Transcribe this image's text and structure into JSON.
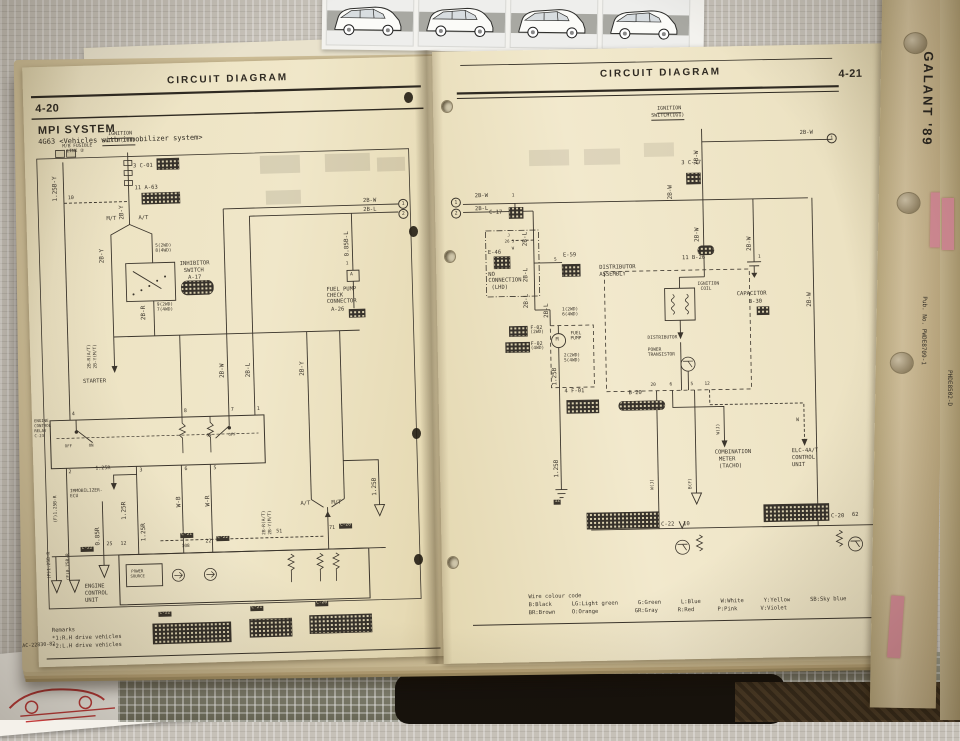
{
  "left_page": {
    "page_number": "4-20",
    "header": "CIRCUIT DIAGRAM",
    "title": "MPI SYSTEM",
    "subtitle": "4G63 <Vehicles with immobilizer system>",
    "footer_code": "AC-22830-82",
    "remarks": {
      "line1": "Remarks",
      "line2": "*1:R.H drive vehicles",
      "line3": "*2:L.H drive vehicles"
    },
    "labels": [
      {
        "t": "M/B FUSIBLE",
        "x": 38,
        "y": 79,
        "s": 4.5
      },
      {
        "t": "LINK ②",
        "x": 42,
        "y": 84,
        "s": 4.5
      },
      {
        "t": "IGNITION",
        "x": 84,
        "y": 67,
        "s": 5,
        "c": "ul"
      },
      {
        "t": "SWITCH(IG1)",
        "x": 78,
        "y": 74,
        "s": 5,
        "c": "ul"
      },
      {
        "t": "1.25B-Y",
        "x": 27,
        "y": 135,
        "c": "rot"
      },
      {
        "t": "10",
        "x": 42,
        "y": 130,
        "s": 5
      },
      {
        "t": "3 C-01",
        "x": 108,
        "y": 100,
        "s": 5.5
      },
      {
        "t": "11 A-63",
        "x": 109,
        "y": 122,
        "s": 5.5
      },
      {
        "t": "2B-Y",
        "x": 93,
        "y": 155,
        "c": "rot"
      },
      {
        "t": "M/T",
        "x": 80,
        "y": 152,
        "s": 5.5
      },
      {
        "t": "A/T",
        "x": 112,
        "y": 152,
        "s": 5.5
      },
      {
        "t": "2B-Y",
        "x": 72,
        "y": 198,
        "c": "rot"
      },
      {
        "t": "5(2WD)",
        "x": 128,
        "y": 181,
        "s": 4.5
      },
      {
        "t": "8(4WD)",
        "x": 128,
        "y": 186,
        "s": 4.5
      },
      {
        "t": "INHIBITOR",
        "x": 152,
        "y": 199,
        "s": 5.5
      },
      {
        "t": "SWITCH",
        "x": 156,
        "y": 206,
        "s": 5.5
      },
      {
        "t": "A-17",
        "x": 160,
        "y": 213,
        "s": 5.5
      },
      {
        "t": "9(2WD)",
        "x": 128,
        "y": 240,
        "s": 4.5
      },
      {
        "t": "7(4WD)",
        "x": 128,
        "y": 245,
        "s": 4.5
      },
      {
        "t": "2B-R",
        "x": 112,
        "y": 256,
        "c": "rot"
      },
      {
        "t": "2B-R(A/T)",
        "x": 58,
        "y": 303,
        "c": "rot",
        "s": 4.5
      },
      {
        "t": "2B-Y(M/T)",
        "x": 64,
        "y": 303,
        "c": "rot",
        "s": 4.5
      },
      {
        "t": "STARTER",
        "x": 52,
        "y": 314,
        "s": 5.5
      },
      {
        "t": "2B-W",
        "x": 189,
        "y": 316,
        "c": "rot"
      },
      {
        "t": "2B-L",
        "x": 215,
        "y": 316,
        "c": "rot"
      },
      {
        "t": "2B-Y",
        "x": 269,
        "y": 316,
        "c": "rot"
      },
      {
        "t": "2B-W",
        "x": 337,
        "y": 141,
        "s": 5.5
      },
      {
        "t": "2B-L",
        "x": 337,
        "y": 150,
        "s": 5.5
      },
      {
        "t": "1",
        "x": 372,
        "y": 142,
        "c": "circ"
      },
      {
        "t": "2",
        "x": 372,
        "y": 152,
        "c": "circ"
      },
      {
        "t": "0.85B-L",
        "x": 317,
        "y": 198,
        "c": "rot"
      },
      {
        "t": "1",
        "x": 318,
        "y": 204,
        "s": 4.5
      },
      {
        "t": "A",
        "x": 322,
        "y": 215,
        "s": 4.5
      },
      {
        "t": "FUEL PUMP",
        "x": 298,
        "y": 229,
        "s": 5.5
      },
      {
        "t": "CHECK",
        "x": 298,
        "y": 235,
        "s": 5.5
      },
      {
        "t": "CONNECTOR",
        "x": 298,
        "y": 241,
        "s": 5.5
      },
      {
        "t": "A-26",
        "x": 302,
        "y": 249,
        "s": 5.5
      },
      {
        "t": "ENGINE",
        "x": 2,
        "y": 352,
        "s": 4
      },
      {
        "t": "CONTROL",
        "x": 2,
        "y": 357,
        "s": 4
      },
      {
        "t": "RELAY",
        "x": 2,
        "y": 362,
        "s": 4
      },
      {
        "t": "C-23",
        "x": 2,
        "y": 367,
        "s": 4
      },
      {
        "t": "4",
        "x": 40,
        "y": 346,
        "s": 5
      },
      {
        "t": "8",
        "x": 152,
        "y": 346,
        "s": 5
      },
      {
        "t": "7",
        "x": 199,
        "y": 346,
        "s": 5
      },
      {
        "t": "1",
        "x": 225,
        "y": 346,
        "s": 5
      },
      {
        "t": "OFF",
        "x": 32,
        "y": 378,
        "s": 4
      },
      {
        "t": "ON",
        "x": 56,
        "y": 378,
        "s": 4
      },
      {
        "t": "ON",
        "x": 174,
        "y": 371,
        "s": 4
      },
      {
        "t": "OFF",
        "x": 196,
        "y": 371,
        "s": 4
      },
      {
        "t": "2",
        "x": 35,
        "y": 404,
        "s": 5
      },
      {
        "t": "3",
        "x": 106,
        "y": 404,
        "s": 5
      },
      {
        "t": "6",
        "x": 151,
        "y": 404,
        "s": 5
      },
      {
        "t": "5",
        "x": 180,
        "y": 404,
        "s": 5
      },
      {
        "t": "1.25R",
        "x": 62,
        "y": 401,
        "s": 5
      },
      {
        "t": "IMMOBILIZER-",
        "x": 36,
        "y": 424,
        "s": 4.5
      },
      {
        "t": "ECU",
        "x": 36,
        "y": 429,
        "s": 4.5
      },
      {
        "t": "(F)1.25B-R",
        "x": 20,
        "y": 456,
        "c": "rot",
        "s": 4.5
      },
      {
        "t": "0.85R",
        "x": 60,
        "y": 480,
        "c": "rot"
      },
      {
        "t": "1.25R",
        "x": 87,
        "y": 455,
        "c": "rot"
      },
      {
        "t": "1.25R",
        "x": 106,
        "y": 477,
        "c": "rot"
      },
      {
        "t": "W-B",
        "x": 142,
        "y": 444,
        "c": "rot"
      },
      {
        "t": "W-R",
        "x": 171,
        "y": 444,
        "c": "rot"
      },
      {
        "t": "C-22",
        "x": 45,
        "y": 481,
        "c": "tag",
        "s": 4.5
      },
      {
        "t": "25",
        "x": 71,
        "y": 477,
        "s": 5
      },
      {
        "t": "12",
        "x": 85,
        "y": 477,
        "s": 5
      },
      {
        "t": "C-21",
        "x": 145,
        "y": 470,
        "c": "tag",
        "s": 4.5
      },
      {
        "t": "108",
        "x": 146,
        "y": 482,
        "s": 4.5
      },
      {
        "t": "22",
        "x": 170,
        "y": 477,
        "s": 5
      },
      {
        "t": "C-22",
        "x": 181,
        "y": 474,
        "c": "tag",
        "s": 4.5
      },
      {
        "t": "51",
        "x": 241,
        "y": 469,
        "s": 5
      },
      {
        "t": "A/T",
        "x": 266,
        "y": 442,
        "s": 5.5
      },
      {
        "t": "M/T",
        "x": 297,
        "y": 442,
        "s": 5.5
      },
      {
        "t": "1.25B",
        "x": 338,
        "y": 438,
        "c": "rot"
      },
      {
        "t": "71",
        "x": 294,
        "y": 467,
        "s": 5
      },
      {
        "t": "C-20",
        "x": 304,
        "y": 465,
        "c": "tag",
        "s": 4.5
      },
      {
        "t": "2B-R(A/T)",
        "x": 228,
        "y": 474,
        "c": "rot",
        "s": 4.5
      },
      {
        "t": "2B-Y(M/T)",
        "x": 234,
        "y": 474,
        "c": "rot",
        "s": 4.5
      },
      {
        "t": "POWER",
        "x": 95,
        "y": 505,
        "s": 4
      },
      {
        "t": "SOURCE",
        "x": 94,
        "y": 510,
        "s": 4
      },
      {
        "t": "ENGINE",
        "x": 48,
        "y": 519,
        "s": 5.5
      },
      {
        "t": "CONTROL",
        "x": 48,
        "y": 526,
        "s": 5.5
      },
      {
        "t": "UNIT",
        "x": 48,
        "y": 533,
        "s": 5.5
      },
      {
        "t": "(F)1.25B-R",
        "x": 12,
        "y": 512,
        "c": "rot",
        "s": 4.5
      },
      {
        "t": "(F)0.75B-R",
        "x": 31,
        "y": 514,
        "c": "rot",
        "s": 4.5
      },
      {
        "t": "C-22",
        "x": 121,
        "y": 548,
        "c": "tag",
        "s": 4.5
      },
      {
        "t": "C-21",
        "x": 213,
        "y": 545,
        "c": "tag",
        "s": 4.5
      },
      {
        "t": "C-20",
        "x": 278,
        "y": 542,
        "c": "tag",
        "s": 4.5
      }
    ]
  },
  "right_page": {
    "page_number": "4-21",
    "header": "CIRCUIT DIAGRAM",
    "wire_colour_code": {
      "title": "Wire colour code",
      "line1": "B:Black      LG:Light green      G:Green      L:Blue      W:White      Y:Yellow      SB:Sky blue",
      "line2": "BR:Brown     O:Orange           GR:Gray      R:Red       P:Pink       V:Violet"
    },
    "labels": [
      {
        "t": "IGNITION",
        "x": 224,
        "y": 59,
        "s": 5,
        "c": "ul"
      },
      {
        "t": "SWITCH(IG1)",
        "x": 218,
        "y": 66,
        "s": 5,
        "c": "ul"
      },
      {
        "t": "2B-W",
        "x": 260,
        "y": 118,
        "c": "rot"
      },
      {
        "t": "2B-W",
        "x": 366,
        "y": 86,
        "s": 5.5
      },
      {
        "t": "1",
        "x": 393,
        "y": 89,
        "c": "circ"
      },
      {
        "t": "2B-W",
        "x": 40,
        "y": 143,
        "s": 5.5
      },
      {
        "t": "1",
        "x": 16,
        "y": 146,
        "c": "circ"
      },
      {
        "t": "2B-L",
        "x": 40,
        "y": 156,
        "s": 5.5
      },
      {
        "t": "2",
        "x": 16,
        "y": 157,
        "c": "circ"
      },
      {
        "t": "1",
        "x": 77,
        "y": 144,
        "s": 4.5
      },
      {
        "t": "C-17",
        "x": 54,
        "y": 160,
        "s": 5.5
      },
      {
        "t": "3 C-17",
        "x": 247,
        "y": 114,
        "s": 5.5
      },
      {
        "t": "2B-W",
        "x": 233,
        "y": 152,
        "c": "rot"
      },
      {
        "t": "2B-L",
        "x": 87,
        "y": 196,
        "c": "rot"
      },
      {
        "t": "2B-L",
        "x": 87,
        "y": 232,
        "c": "rot"
      },
      {
        "t": "2B-L",
        "x": 87,
        "y": 258,
        "c": "rot"
      },
      {
        "t": "J",
        "x": 72,
        "y": 183,
        "s": 4
      },
      {
        "t": "26 3",
        "x": 69,
        "y": 189,
        "s": 4
      },
      {
        "t": "W",
        "x": 76,
        "y": 196,
        "s": 4
      },
      {
        "t": "E-46",
        "x": 52,
        "y": 200,
        "s": 5.5
      },
      {
        "t": "NO",
        "x": 52,
        "y": 222,
        "s": 5.5
      },
      {
        "t": "CONNECTION",
        "x": 52,
        "y": 228,
        "s": 5.5
      },
      {
        "t": "(LHD)",
        "x": 55,
        "y": 235,
        "s": 5.5
      },
      {
        "t": "5",
        "x": 118,
        "y": 209,
        "s": 4.5
      },
      {
        "t": "E-59",
        "x": 127,
        "y": 204,
        "s": 5.5
      },
      {
        "t": "DISTRIBUTOR",
        "x": 163,
        "y": 217,
        "s": 5.5
      },
      {
        "t": "ASSEMBLY",
        "x": 163,
        "y": 224,
        "s": 5.5
      },
      {
        "t": "11 B-26",
        "x": 246,
        "y": 209,
        "s": 5.5
      },
      {
        "t": "2B-W",
        "x": 259,
        "y": 195,
        "c": "rot"
      },
      {
        "t": "IGNITION",
        "x": 261,
        "y": 236,
        "s": 4.5
      },
      {
        "t": "COIL",
        "x": 264,
        "y": 241,
        "s": 4.5
      },
      {
        "t": "DISTRIBUTOR",
        "x": 210,
        "y": 289,
        "s": 4.5
      },
      {
        "t": "POWER",
        "x": 210,
        "y": 301,
        "s": 4.5
      },
      {
        "t": "TRANSISTOR",
        "x": 210,
        "y": 306,
        "s": 4.5
      },
      {
        "t": "2B-W",
        "x": 311,
        "y": 205,
        "c": "rot"
      },
      {
        "t": "1",
        "x": 322,
        "y": 210,
        "s": 4.5
      },
      {
        "t": "CAPACITOR",
        "x": 300,
        "y": 246,
        "s": 5.5
      },
      {
        "t": "B-30",
        "x": 312,
        "y": 254,
        "s": 5.5
      },
      {
        "t": "2B-W",
        "x": 370,
        "y": 262,
        "c": "rot"
      },
      {
        "t": "2B-L",
        "x": 107,
        "y": 268,
        "c": "rot"
      },
      {
        "t": "1(2WD)",
        "x": 125,
        "y": 259,
        "s": 4.5
      },
      {
        "t": "6(4WD)",
        "x": 125,
        "y": 264,
        "s": 4.5
      },
      {
        "t": "F-02",
        "x": 93,
        "y": 276,
        "s": 5
      },
      {
        "t": "(2WD)",
        "x": 93,
        "y": 281,
        "s": 4.5
      },
      {
        "t": "F-02",
        "x": 93,
        "y": 292,
        "s": 5
      },
      {
        "t": "(4WD)",
        "x": 93,
        "y": 297,
        "s": 4.5
      },
      {
        "t": "FUEL",
        "x": 133,
        "y": 283,
        "s": 4.5
      },
      {
        "t": "PUMP",
        "x": 133,
        "y": 288,
        "s": 4.5
      },
      {
        "t": "M",
        "x": 118,
        "y": 288,
        "s": 5
      },
      {
        "t": "2(2WD)",
        "x": 126,
        "y": 305,
        "s": 4.5
      },
      {
        "t": "5(4WD)",
        "x": 126,
        "y": 310,
        "s": 4.5
      },
      {
        "t": "1.25B",
        "x": 114,
        "y": 336,
        "c": "rot"
      },
      {
        "t": "4 F-01",
        "x": 126,
        "y": 340,
        "s": 5.5
      },
      {
        "t": "1.25B",
        "x": 114,
        "y": 428,
        "c": "rot"
      },
      {
        "t": "12",
        "x": 113,
        "y": 450,
        "c": "tag",
        "s": 4.5
      },
      {
        "t": "B-20",
        "x": 190,
        "y": 343,
        "s": 5.5
      },
      {
        "t": "20",
        "x": 212,
        "y": 336,
        "s": 4.5
      },
      {
        "t": "6",
        "x": 231,
        "y": 336,
        "s": 4.5
      },
      {
        "t": "5",
        "x": 252,
        "y": 336,
        "s": 4.5
      },
      {
        "t": "12",
        "x": 266,
        "y": 336,
        "s": 4.5
      },
      {
        "t": "W(J)",
        "x": 278,
        "y": 388,
        "c": "rot",
        "s": 4.5
      },
      {
        "t": "W",
        "x": 357,
        "y": 373,
        "s": 5
      },
      {
        "t": "COMBINATION",
        "x": 275,
        "y": 404,
        "s": 5.5
      },
      {
        "t": "METER",
        "x": 279,
        "y": 411,
        "s": 5.5
      },
      {
        "t": "(TACHO)",
        "x": 279,
        "y": 418,
        "s": 5.5
      },
      {
        "t": "ELC-4A/T",
        "x": 352,
        "y": 404,
        "s": 5.5
      },
      {
        "t": "CONTROL",
        "x": 352,
        "y": 411,
        "s": 5.5
      },
      {
        "t": "UNIT",
        "x": 352,
        "y": 418,
        "s": 5.5
      },
      {
        "t": "W(J)",
        "x": 211,
        "y": 442,
        "c": "rot",
        "s": 4.5
      },
      {
        "t": "B(F)",
        "x": 249,
        "y": 442,
        "c": "rot",
        "s": 4.5
      },
      {
        "t": "C-22",
        "x": 220,
        "y": 475,
        "s": 5.5
      },
      {
        "t": "10",
        "x": 242,
        "y": 475,
        "s": 5.5
      },
      {
        "t": "C-20",
        "x": 390,
        "y": 470,
        "s": 5.5
      },
      {
        "t": "62",
        "x": 411,
        "y": 469,
        "s": 5.5
      }
    ]
  },
  "binder": {
    "spine_title": "GALANT '89",
    "spine_pub_no": "Pub. No. PWDE8709-1",
    "spine2_code": "PHDE8502-D"
  },
  "colors": {
    "page": "#ece2c2",
    "ink": "#3b352c",
    "cloth": "#c6c1b8",
    "spine": "#cdba93",
    "tab_pink": "#d98f9a"
  }
}
